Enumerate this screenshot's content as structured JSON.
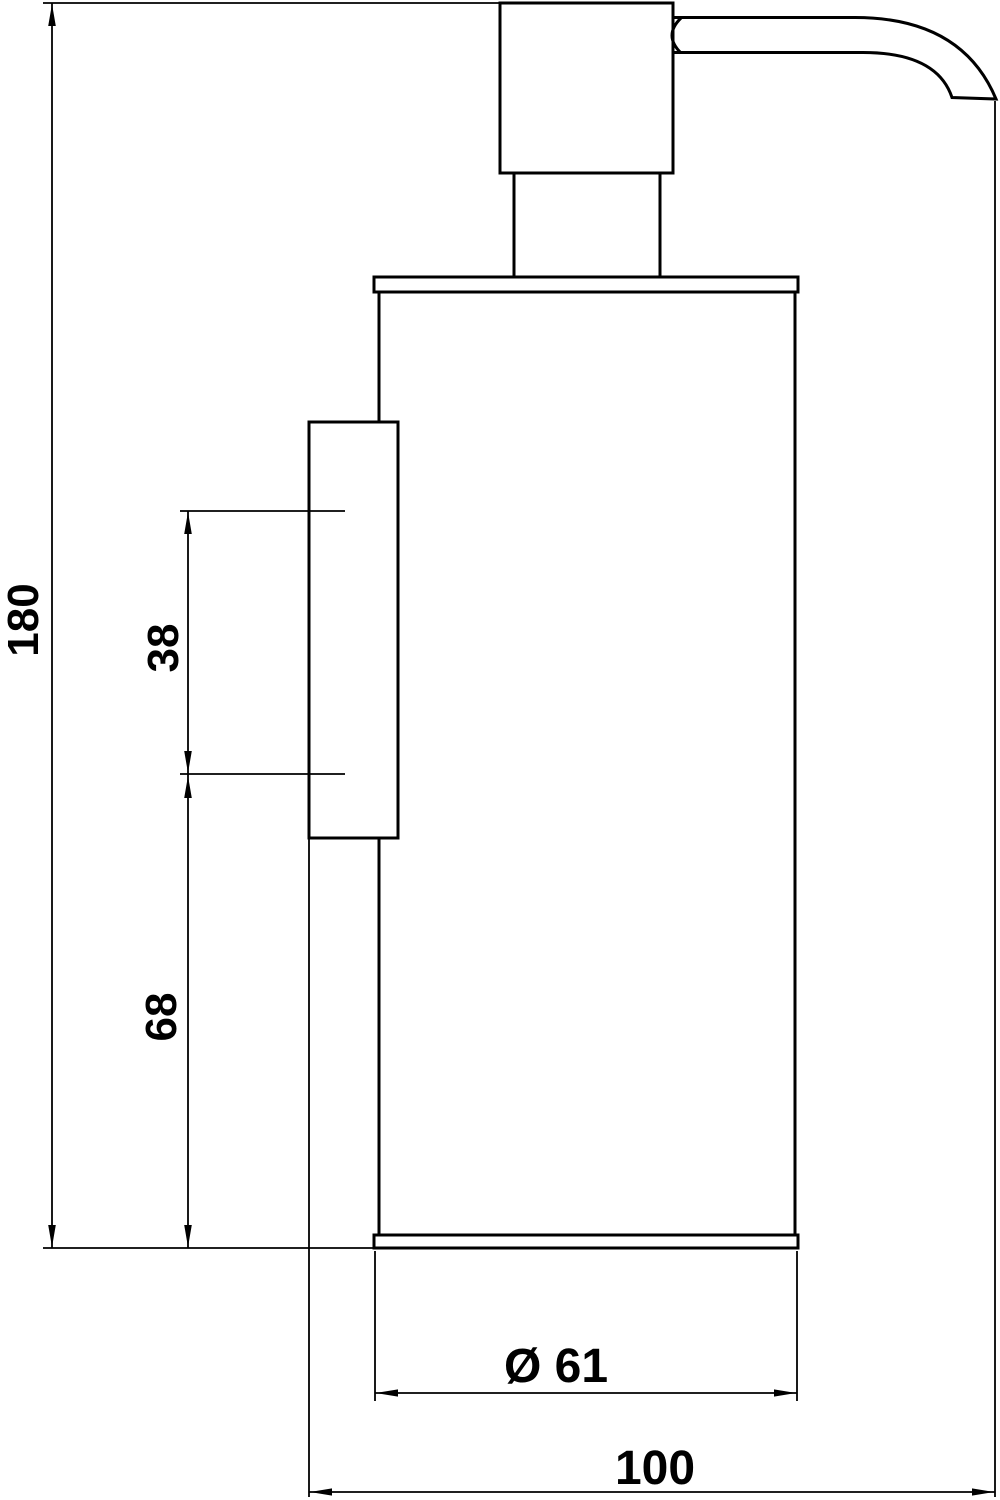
{
  "page": {
    "background_color": "#ffffff",
    "line_color": "#000000"
  },
  "drawing": {
    "type": "technical-dimension-drawing",
    "view": "side-elevation-wall-mounted-soap-dispenser"
  },
  "dimensions": {
    "total_height": "180",
    "upper_spacing": "38",
    "lower_spacing": "68",
    "body_diameter": "Ø 61",
    "depth_from_wall": "100"
  }
}
